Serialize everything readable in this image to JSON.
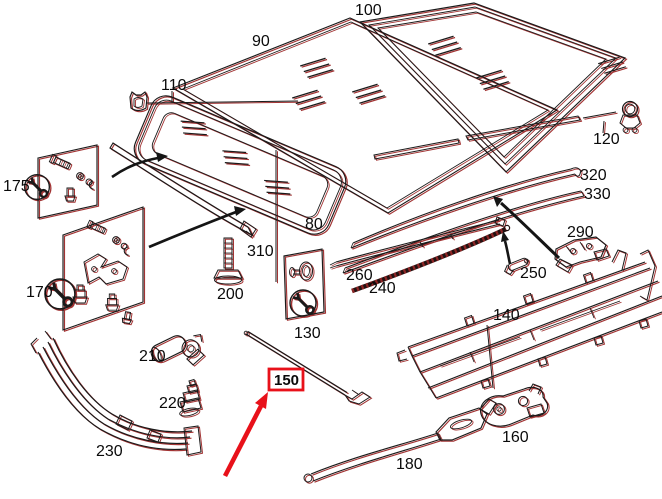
{
  "diagram": {
    "type": "exploded-parts-diagram",
    "background": "#ffffff",
    "line_color": "#1a1a1a",
    "line_shadow_color": "#a23434",
    "highlight_color": "#e8111a",
    "highlighted_part": "150"
  },
  "icons": {
    "wrench_circle": "wrench-icon",
    "roof_clip_110": "clip-icon",
    "molding_clip_120": "ring-clip-icon"
  },
  "labels": {
    "80": "80",
    "90": "90",
    "100": "100",
    "110": "110",
    "120": "120",
    "130": "130",
    "140": "140",
    "150": "150",
    "160": "160",
    "170": "170",
    "175": "175",
    "180": "180",
    "200": "200",
    "210": "210",
    "220": "220",
    "230": "230",
    "240": "240",
    "250": "250",
    "260": "260",
    "290": "290",
    "310": "310",
    "320": "320",
    "330": "330"
  }
}
